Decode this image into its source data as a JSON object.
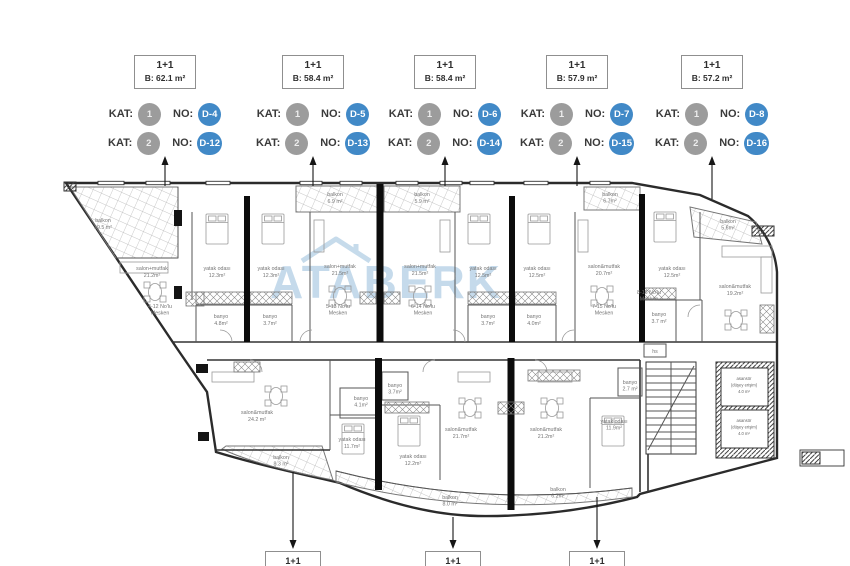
{
  "header": {
    "kat_label": "KAT:",
    "no_label": "NO:",
    "units": [
      {
        "type": "1+1",
        "area": "B: 62.1 m²",
        "rows": [
          {
            "kat": "1",
            "no": "D-4"
          },
          {
            "kat": "2",
            "no": "D-12"
          }
        ]
      },
      {
        "type": "1+1",
        "area": "B: 58.4 m²",
        "rows": [
          {
            "kat": "1",
            "no": "D-5"
          },
          {
            "kat": "2",
            "no": "D-13"
          }
        ]
      },
      {
        "type": "1+1",
        "area": "B: 58.4 m²",
        "rows": [
          {
            "kat": "1",
            "no": "D-6"
          },
          {
            "kat": "2",
            "no": "D-14"
          }
        ]
      },
      {
        "type": "1+1",
        "area": "B: 57.9 m²",
        "rows": [
          {
            "kat": "1",
            "no": "D-7"
          },
          {
            "kat": "2",
            "no": "D-15"
          }
        ]
      },
      {
        "type": "1+1",
        "area": "B: 57.2 m²",
        "rows": [
          {
            "kat": "1",
            "no": "D-8"
          },
          {
            "kat": "2",
            "no": "D-16"
          }
        ]
      }
    ]
  },
  "footer": {
    "boxes": [
      "1+1",
      "1+1",
      "1+1"
    ]
  },
  "plan": {
    "watermark": "ATABERK",
    "colors": {
      "accent_blue": "#4189c7",
      "badge_gray": "#9c9c9c",
      "watermark_blue": "#b9d3e7"
    },
    "rooms": {
      "balkon_left": {
        "n": "balkon",
        "a": "19.5 m²"
      },
      "u1_salon": {
        "n": "salon+mutfak",
        "a": "21.2m²"
      },
      "u1_yatak": {
        "n": "yatak odası",
        "a": "12.3m²"
      },
      "u1_banyo": {
        "n": "banyo",
        "a": "4.8m²"
      },
      "u2_yatak": {
        "n": "yatak odası",
        "a": "12.3m²"
      },
      "u2_banyo": {
        "n": "banyo",
        "a": "3.7m²"
      },
      "u2_salon": {
        "n": "salon+mutfak",
        "a": "21.5m²"
      },
      "u2_balkon": {
        "n": "balkon",
        "a": "6.9 m²"
      },
      "u3_salon": {
        "n": "salon+mutfak",
        "a": "21.5m²"
      },
      "u3_balkon": {
        "n": "balkon",
        "a": "5.9 m²"
      },
      "u3_yatak": {
        "n": "yatak odası",
        "a": "12.5m²"
      },
      "u3_banyo": {
        "n": "banyo",
        "a": "3.7m²"
      },
      "u4_yatak": {
        "n": "yatak odası",
        "a": "12.5m²"
      },
      "u4_banyo": {
        "n": "banyo",
        "a": "4.0m²"
      },
      "u4_salon": {
        "n": "salon&mutfak",
        "a": "20.7m²"
      },
      "u4_balkon": {
        "n": "balkon",
        "a": "6.7m²"
      },
      "u5_yatak": {
        "n": "yatak odası",
        "a": "12.5m²"
      },
      "u5_banyo": {
        "n": "banyo",
        "a": "3.7 m²"
      },
      "u5_salon": {
        "n": "salon&mutfak",
        "a": "19.2m²"
      },
      "u5_balkon": {
        "n": "balkon",
        "a": "5.6m²"
      },
      "l1_salon": {
        "n": "salon&mutfak",
        "a": "24.2 m²"
      },
      "l1_banyo": {
        "n": "banyo",
        "a": "4.1m²"
      },
      "l1_yatak": {
        "n": "yatak odası",
        "a": "11.7m²"
      },
      "l1_balkon": {
        "n": "balkon",
        "a": "8.3 m²"
      },
      "l2_yatak": {
        "n": "yatak odası",
        "a": "12.2m²"
      },
      "l2_banyo": {
        "n": "banyo",
        "a": "3.7m²"
      },
      "l2_salon": {
        "n": "salon&mutfak",
        "a": "21.7m²"
      },
      "l3_salon": {
        "n": "salon&mutfak",
        "a": "21.2m²"
      },
      "l3_yatak": {
        "n": "yatak odası",
        "a": "11.9m²"
      },
      "l3_banyo": {
        "n": "banyo",
        "a": "2.7 m²"
      },
      "balkon_mid": {
        "n": "balkon",
        "a": "8.0 m²"
      },
      "balkon_mid2": {
        "n": "balkon",
        "a": "6.2m²"
      }
    },
    "mesken": [
      {
        "l1": "4-12 No'lu",
        "l2": "Mesken"
      },
      {
        "l1": "5-13 No'lu",
        "l2": "Mesken"
      },
      {
        "l1": "6-14 No'lu",
        "l2": "Mesken"
      },
      {
        "l1": "7-15 No'lu",
        "l2": "Mesken"
      },
      {
        "l1": "8-16 No'lu",
        "l2": "Mesken"
      }
    ],
    "elevator": {
      "l1": "asansör",
      "l2": "(düşey erişim)",
      "l3": "4.0 m²"
    },
    "hs": "hs"
  }
}
